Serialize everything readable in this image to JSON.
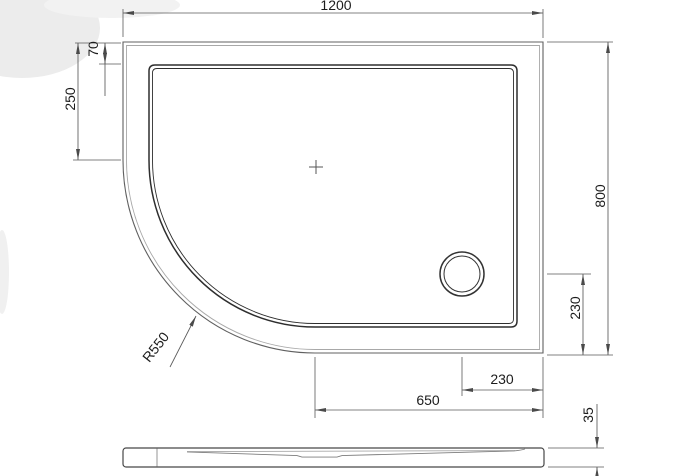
{
  "drawing": {
    "dims": {
      "overall_width": "1200",
      "overall_depth": "800",
      "rim_width": "70",
      "radius_start_offset": "250",
      "corner_radius": "R550",
      "drain_offset_from_bottom": "230",
      "drain_offset_from_right": "230",
      "straight_bottom_edge": "650",
      "tray_height": "35"
    },
    "colors": {
      "outline_main": "#2e2e2e",
      "outline_rim": "#606060",
      "outline_light": "#a8a8a8",
      "dimension_line": "#5a5a5a",
      "arrow": "#4a4a4a",
      "text": "#1c1c1c",
      "background": "#ffffff"
    }
  }
}
